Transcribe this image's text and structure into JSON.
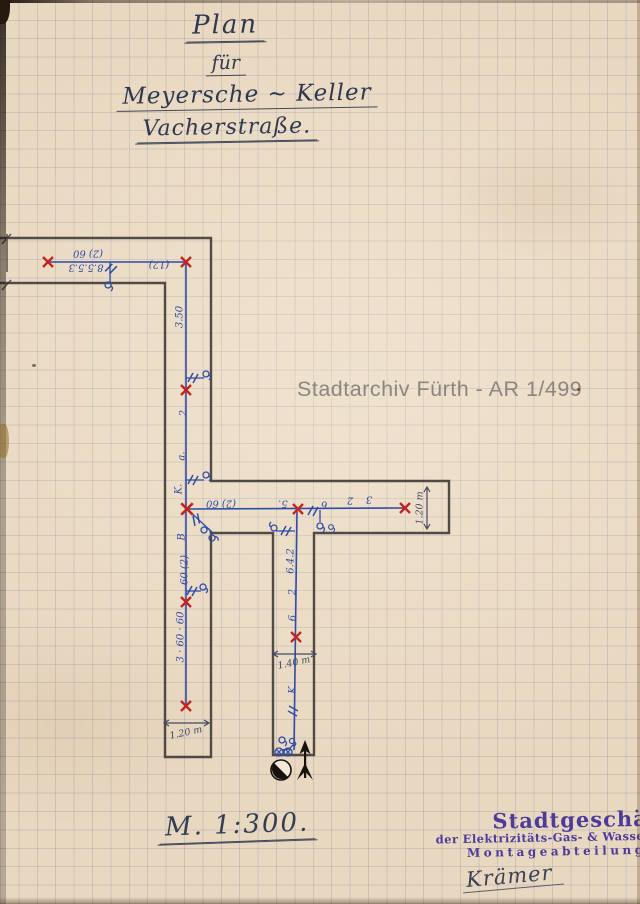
{
  "document": {
    "title": {
      "line1": "Plan",
      "line2": "für",
      "line3": "Meyersche ~ Keller",
      "line4": "Vacherstraße."
    },
    "watermark": "Stadtarchiv Fürth - AR 1/499",
    "scale_label": "M. 1:300.",
    "stamp": {
      "org": "Stadtgeschäft",
      "dept": "der Elektrizitäts-Gas- & Wasserwer",
      "division": "Montageabteilung.",
      "signature": "Krämer"
    }
  },
  "plan": {
    "annotations": [
      "(2) 60",
      "8.5.5.3",
      "(12)",
      "3.50",
      "2",
      "a.",
      "K.",
      "(2) 60",
      "B",
      "60 (2)",
      "3 · 60 · 60",
      "5.",
      "6",
      "2",
      "3",
      "6.4.2",
      "2",
      "6",
      "K"
    ],
    "dimensions": [
      "1.20 m",
      "1.20 m",
      "1.40 m"
    ],
    "colors": {
      "paper": "#e9d8c0",
      "ink_blue": "#2e4da6",
      "mark_red": "#c3231f",
      "wall_ink": "#3b3733",
      "stamp_purple": "#4c3b9b",
      "title_ink": "#2e3950",
      "watermark_gray": "#807f79"
    }
  }
}
